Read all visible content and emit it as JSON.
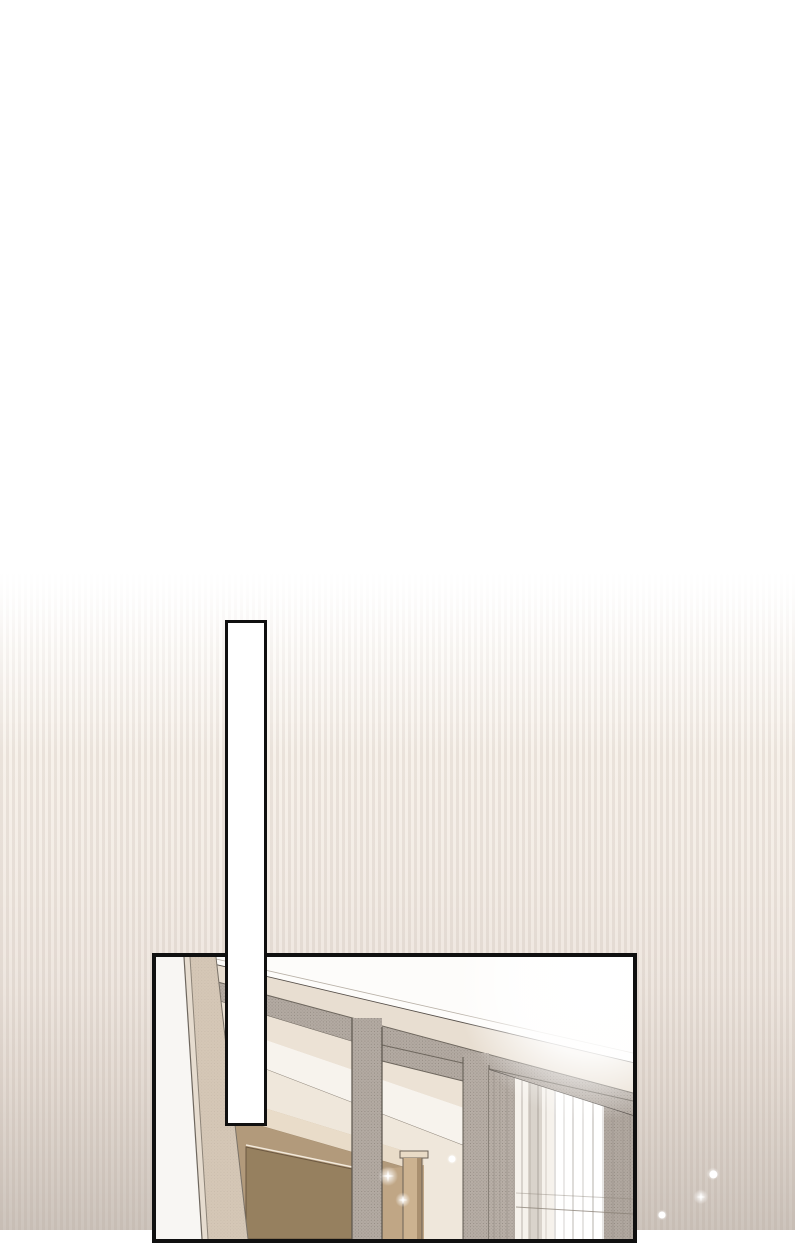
{
  "page": {
    "kind": "webtoon-page-segment",
    "width_px": 795,
    "height_px": 1230,
    "visible_text": ""
  },
  "theme": {
    "ink": "#101010",
    "bg_top": "#ffffff",
    "bg_bottom": "#cdc4bc",
    "stripe_tint": "rgba(173,157,146,0.18)",
    "palette": {
      "cream_beam": "#e8ded1",
      "grey_beam": "#b3aaa2",
      "tan_wall": "#d5c7b6",
      "brown_wall": "#b29a7b",
      "beige_band": "#e9dcc9",
      "cabinet": "#96805f",
      "curtain_base": "#f6f2ec",
      "curtain_grey": "#b8afa7",
      "light": "#ffffff"
    }
  },
  "white_bar": {
    "x": 225,
    "y": 620,
    "width": 42,
    "height": 506,
    "border_px": 3
  },
  "panel": {
    "x": 152,
    "y": 953,
    "width": 485,
    "height": 290,
    "border_px": 4,
    "scene": "sunlit interior: coffered ceiling beams and grey portal frames receding to the right, white left wall, brown lower walls and cabinet, short tan pillar, sheer curtains with bright window light"
  },
  "sparkles": [
    {
      "x": 388,
      "y": 1176,
      "size": 9,
      "type": "star"
    },
    {
      "x": 403,
      "y": 1200,
      "size": 7,
      "type": "star"
    },
    {
      "x": 452,
      "y": 1159,
      "size": 5,
      "type": "dot"
    },
    {
      "x": 713,
      "y": 1174,
      "size": 6,
      "type": "dot"
    },
    {
      "x": 701,
      "y": 1197,
      "size": 7,
      "type": "star"
    },
    {
      "x": 662,
      "y": 1215,
      "size": 5,
      "type": "dot"
    }
  ]
}
